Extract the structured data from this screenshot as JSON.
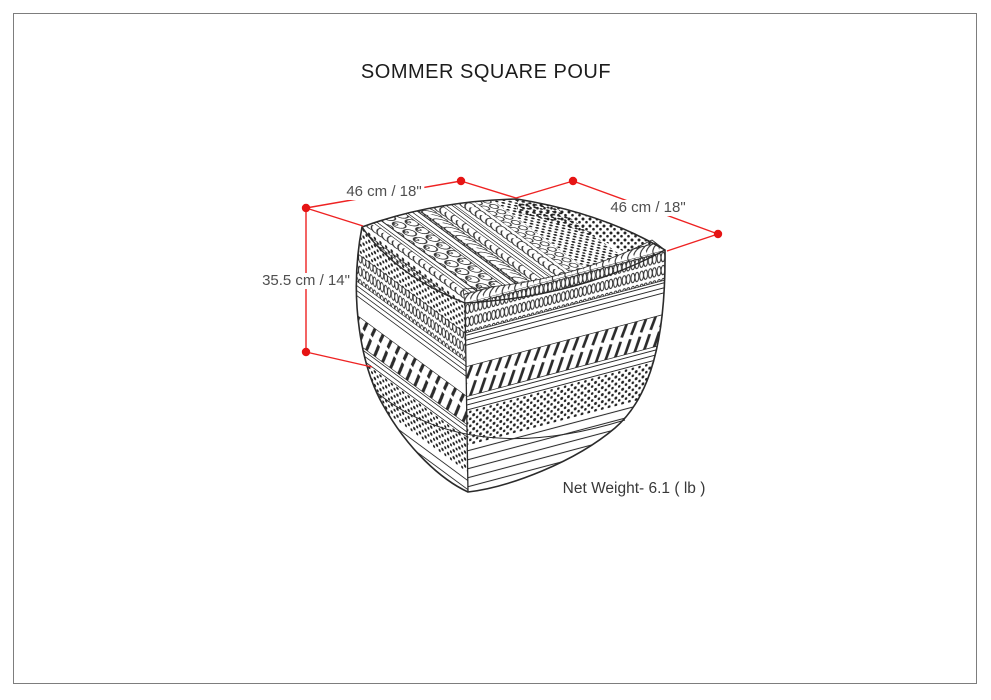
{
  "page": {
    "title": "SOMMER SQUARE POUF",
    "background": "#ffffff",
    "border_color": "#7d7d7d"
  },
  "diagram": {
    "dimensions": {
      "width_left": "46 cm / 18\"",
      "width_right": "46 cm / 18\"",
      "height": "35.5 cm / 14\""
    },
    "net_weight": "Net Weight- 6.1 ( lb )",
    "colors": {
      "dimension_line": "#ee2222",
      "dimension_dot": "#e61414",
      "label_text": "#4f4f4f",
      "title_text": "#1c1c1c",
      "line_art": "#2b2b2b"
    }
  }
}
